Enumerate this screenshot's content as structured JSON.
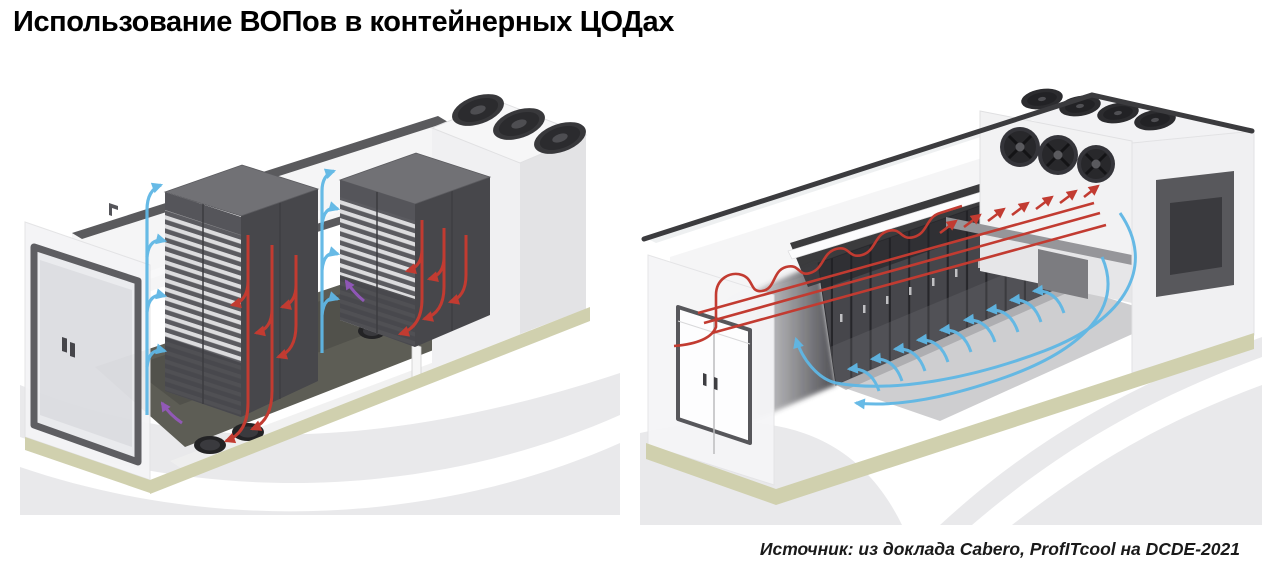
{
  "slide": {
    "title": "Использование ВОПов в контейнерных ЦОДах",
    "source_caption": "Источник: из доклада Cabero, ProfITcool на DCDE-2021"
  },
  "illustrations": {
    "left": "container-datacenter-two-racks-airflow",
    "right": "container-datacenter-rack-row-fanwall-airflow"
  },
  "palette": {
    "hot_air_red": "#c23b31",
    "cold_air_blue": "#5fb7e5",
    "accent_purple": "#9b59c8",
    "container_base_olive": "#d0d0ae",
    "rack_dark_gray": "#47474b",
    "fan_dark": "#2e2e31",
    "background_swoosh_gray": "#e9e9eb"
  }
}
